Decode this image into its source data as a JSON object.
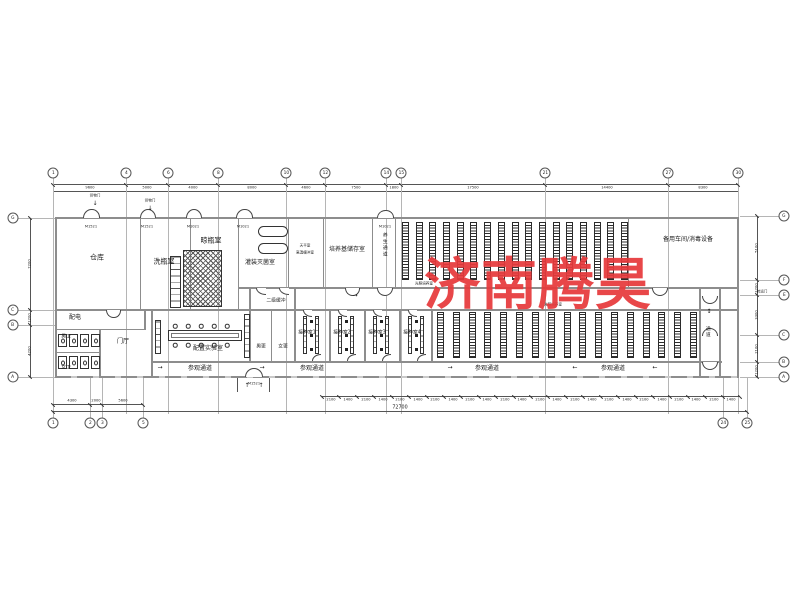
{
  "watermark": {
    "text": "济南腾昊",
    "color": "#E73A3C"
  },
  "rooms": {
    "warehouse": "仓库",
    "bottle_washing": "洗瓶室",
    "bottle_drying": "晾瓶室",
    "filling_sterilizing": "灌装灭菌室",
    "balance_room": "天平室",
    "hot_buffer": "高温缓冲室",
    "medium_storage": "培养基储存室",
    "curing_corridor": "养生通道",
    "light_culture": "光照培养室",
    "spare_workshop": "备用车间/消毒设备",
    "power_room": "配电",
    "mens_toilet": "男卫",
    "womens_toilet": "女卫",
    "entrance_hall": "门厅",
    "prep_lab": "配置实验室",
    "secondary_buffer": "二级缓冲",
    "mens_changing": "男更",
    "womens_changing": "女更",
    "inoculation_1": "接种室1",
    "inoculation_2": "接种室2",
    "inoculation_3": "接种室3",
    "inoculation_4": "接种室4",
    "visitor_corridor": "参观通道",
    "side_corridor": "通道"
  },
  "annotations": {
    "cargo_door": "货物门",
    "transfer_door": "转运门",
    "door_tag_1": "M1521",
    "door_tag_2": "M1021"
  },
  "icons": {
    "arrow_right": "→",
    "arrow_left": "←",
    "arrow_down": "↓",
    "arrow_up": "↑",
    "arrow_updown": "↕"
  },
  "grid": {
    "top": [
      {
        "id": "1",
        "x": 53
      },
      {
        "id": "4",
        "x": 126
      },
      {
        "id": "6",
        "x": 168
      },
      {
        "id": "8",
        "x": 218
      },
      {
        "id": "10",
        "x": 286
      },
      {
        "id": "12",
        "x": 325
      },
      {
        "id": "14",
        "x": 386
      },
      {
        "id": "15",
        "x": 401
      },
      {
        "id": "21",
        "x": 545
      },
      {
        "id": "27",
        "x": 668
      },
      {
        "id": "30",
        "x": 738
      }
    ],
    "top_dims": [
      "9600",
      "5000",
      "4000",
      "8000",
      "4600",
      "7500",
      "1800",
      "17500",
      "14400",
      "8300"
    ],
    "bottom": [
      {
        "id": "1",
        "x": 53
      },
      {
        "id": "2",
        "x": 90
      },
      {
        "id": "3",
        "x": 102
      },
      {
        "id": "5",
        "x": 143
      },
      {
        "id": "24",
        "x": 723
      },
      {
        "id": "25",
        "x": 747
      }
    ],
    "bottom_dims": [
      "4300",
      "2000",
      "5600"
    ],
    "left": [
      {
        "id": "G",
        "y": 218
      },
      {
        "id": "C",
        "y": 310
      },
      {
        "id": "B",
        "y": 325
      },
      {
        "id": "A",
        "y": 377
      }
    ],
    "left_dims": [
      "7200",
      "1200",
      "4200"
    ],
    "right": [
      {
        "id": "G",
        "y": 216
      },
      {
        "id": "F",
        "y": 280
      },
      {
        "id": "E",
        "y": 295
      },
      {
        "id": "C",
        "y": 335
      },
      {
        "id": "B",
        "y": 362
      },
      {
        "id": "A",
        "y": 377
      }
    ],
    "right_dims": [
      "5100",
      "1200",
      "3300",
      "2100",
      "1200"
    ],
    "tick_row": {
      "values_pattern": [
        "2100",
        "1400"
      ],
      "count": 24,
      "start_x": 322,
      "end_x": 740,
      "y": 396
    },
    "total_dim": "72700"
  },
  "racks": {
    "upper": {
      "count": 17,
      "x": 402,
      "end_x": 628,
      "y": 222,
      "h": 58
    },
    "lower": {
      "count": 17,
      "x": 437,
      "end_x": 697,
      "y": 312,
      "h": 46
    }
  },
  "inoculation_room_x": [
    295,
    330,
    365,
    400
  ],
  "lab_chair_x": [
    175,
    188,
    201,
    214,
    227
  ],
  "toilet_stall_x": [
    58,
    69,
    80,
    91
  ]
}
